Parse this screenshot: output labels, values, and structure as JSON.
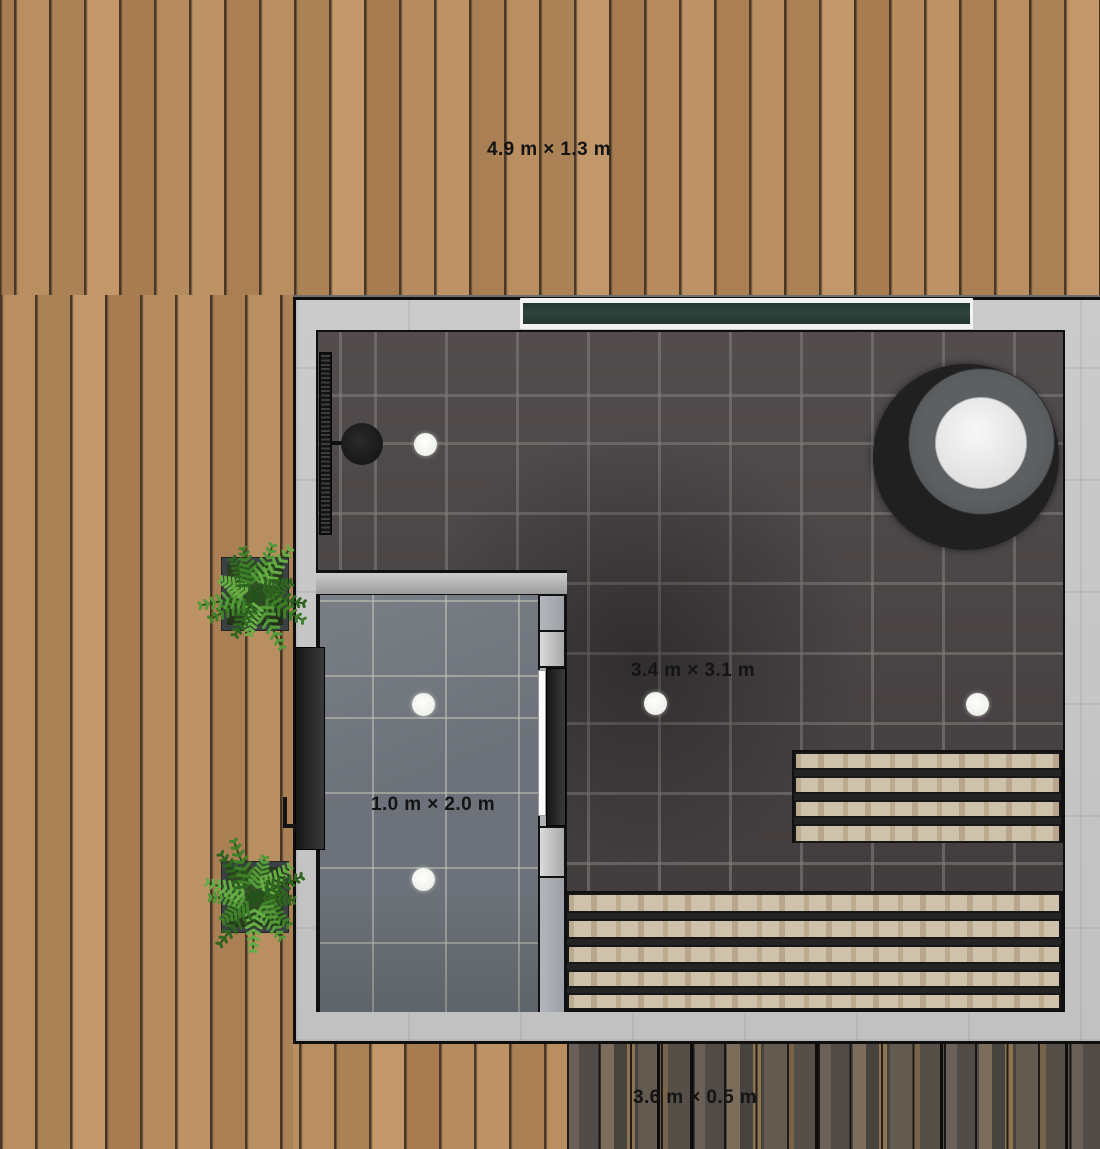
{
  "labels": {
    "top_deck": "4.9 m × 1.3 m",
    "main_room": "3.4 m × 3.1 m",
    "shower_room": "1.0 m × 2.0 m",
    "bottom_planter": "3.6 m × 0.5 m"
  },
  "objects": {
    "decks": [
      "top-deck",
      "left-deck",
      "bottom-deck-light",
      "bottom-planter-deck"
    ],
    "rooms": [
      "sauna-room",
      "shower-room"
    ],
    "fixtures": [
      "window",
      "shower-column",
      "hot-tub",
      "upper-bench",
      "lower-bench",
      "exterior-door",
      "shower-room-door",
      "ceiling-light x5",
      "fern-planter x2"
    ]
  },
  "colors": {
    "deck_wood": "#b1875a",
    "dark_deck_wood": "#59524b",
    "wall": "#c6c6c6",
    "sauna_tile": "#453f40",
    "shower_tile": "#6d727a",
    "window_glass": "#2e443c",
    "bench_wood": "#cec2ac",
    "plant_green": "#3f8129",
    "fixture_dark": "#1c1c1c",
    "light_white": "#f3f5ee",
    "label_text": "#141414"
  }
}
